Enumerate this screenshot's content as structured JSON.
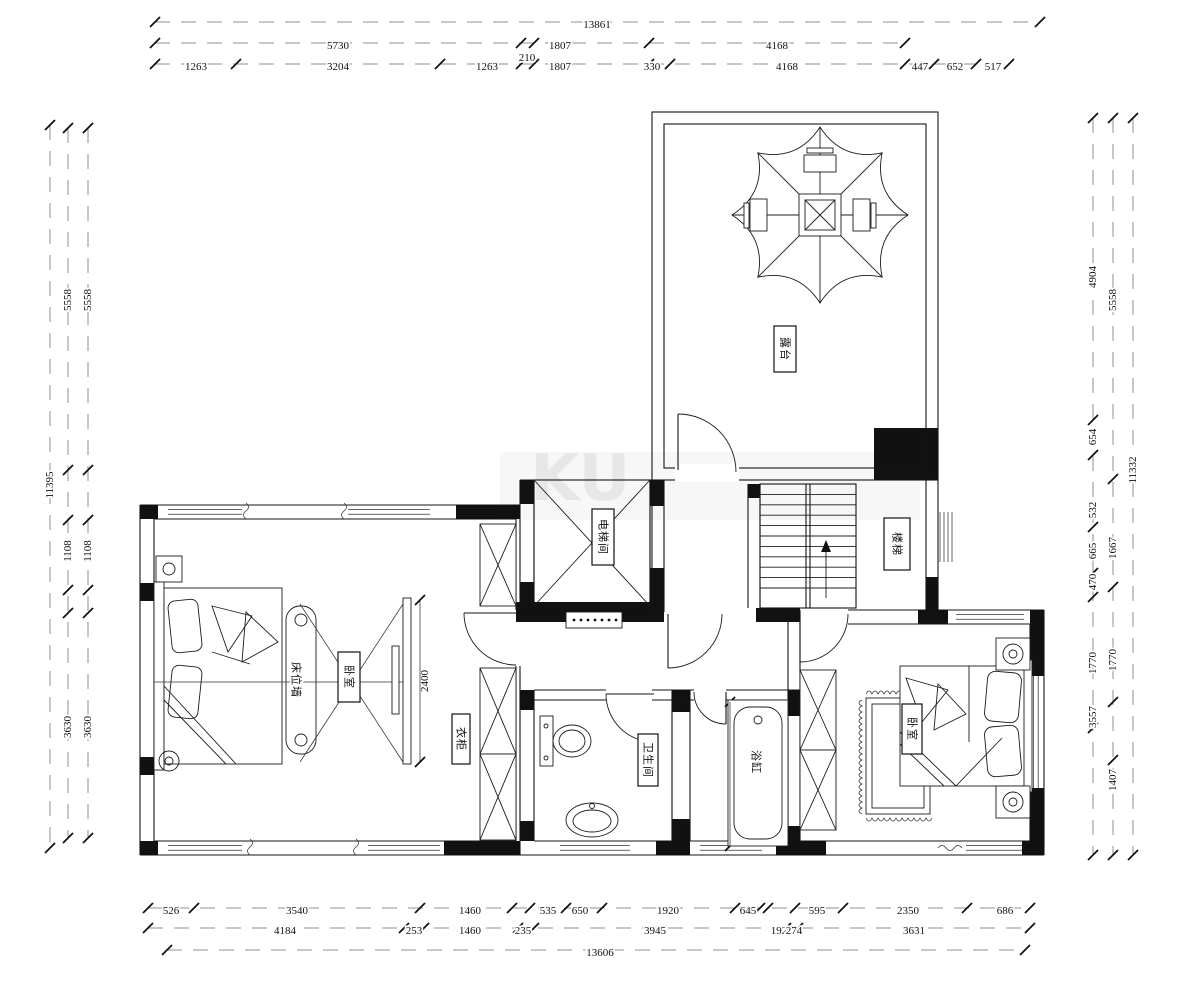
{
  "drawing": {
    "watermark": "KU",
    "rooms": {
      "balcony": "露台",
      "elevator": "电梯间",
      "stairs": "楼梯",
      "bedroom_left": "卧室",
      "bed_wall": "床位墙",
      "wardrobe": "衣柜",
      "bathroom": "卫生间",
      "bathtub": "浴缸",
      "bedroom_right": "卧室"
    },
    "inner_dimensions": {
      "tv_wall": "2400",
      "bathtub_length": "1800"
    },
    "dimensions": {
      "top_total": "13861",
      "top_row2": [
        "5730",
        "210",
        "1807",
        "4168"
      ],
      "top_row3": [
        "1263",
        "3204",
        "1263",
        "1807",
        "330",
        "4168",
        "447",
        "652",
        "517"
      ],
      "left_total": "11395",
      "left_chain": [
        "5558",
        "1108",
        "3630"
      ],
      "right_total": "11332",
      "right_mid": [
        "5558",
        "1667",
        "1770",
        "1407"
      ],
      "right_inner": [
        "4904",
        "654",
        "532",
        "665",
        "470",
        "1770",
        "3557"
      ],
      "bottom_row1": [
        "526",
        "3540",
        "1460",
        "535",
        "650",
        "1920",
        "645",
        "595",
        "2350",
        "686"
      ],
      "bottom_row2": [
        "4184",
        "253",
        "1460",
        "235",
        "3945",
        "192",
        "274",
        "3631"
      ],
      "bottom_total": "13606"
    }
  }
}
